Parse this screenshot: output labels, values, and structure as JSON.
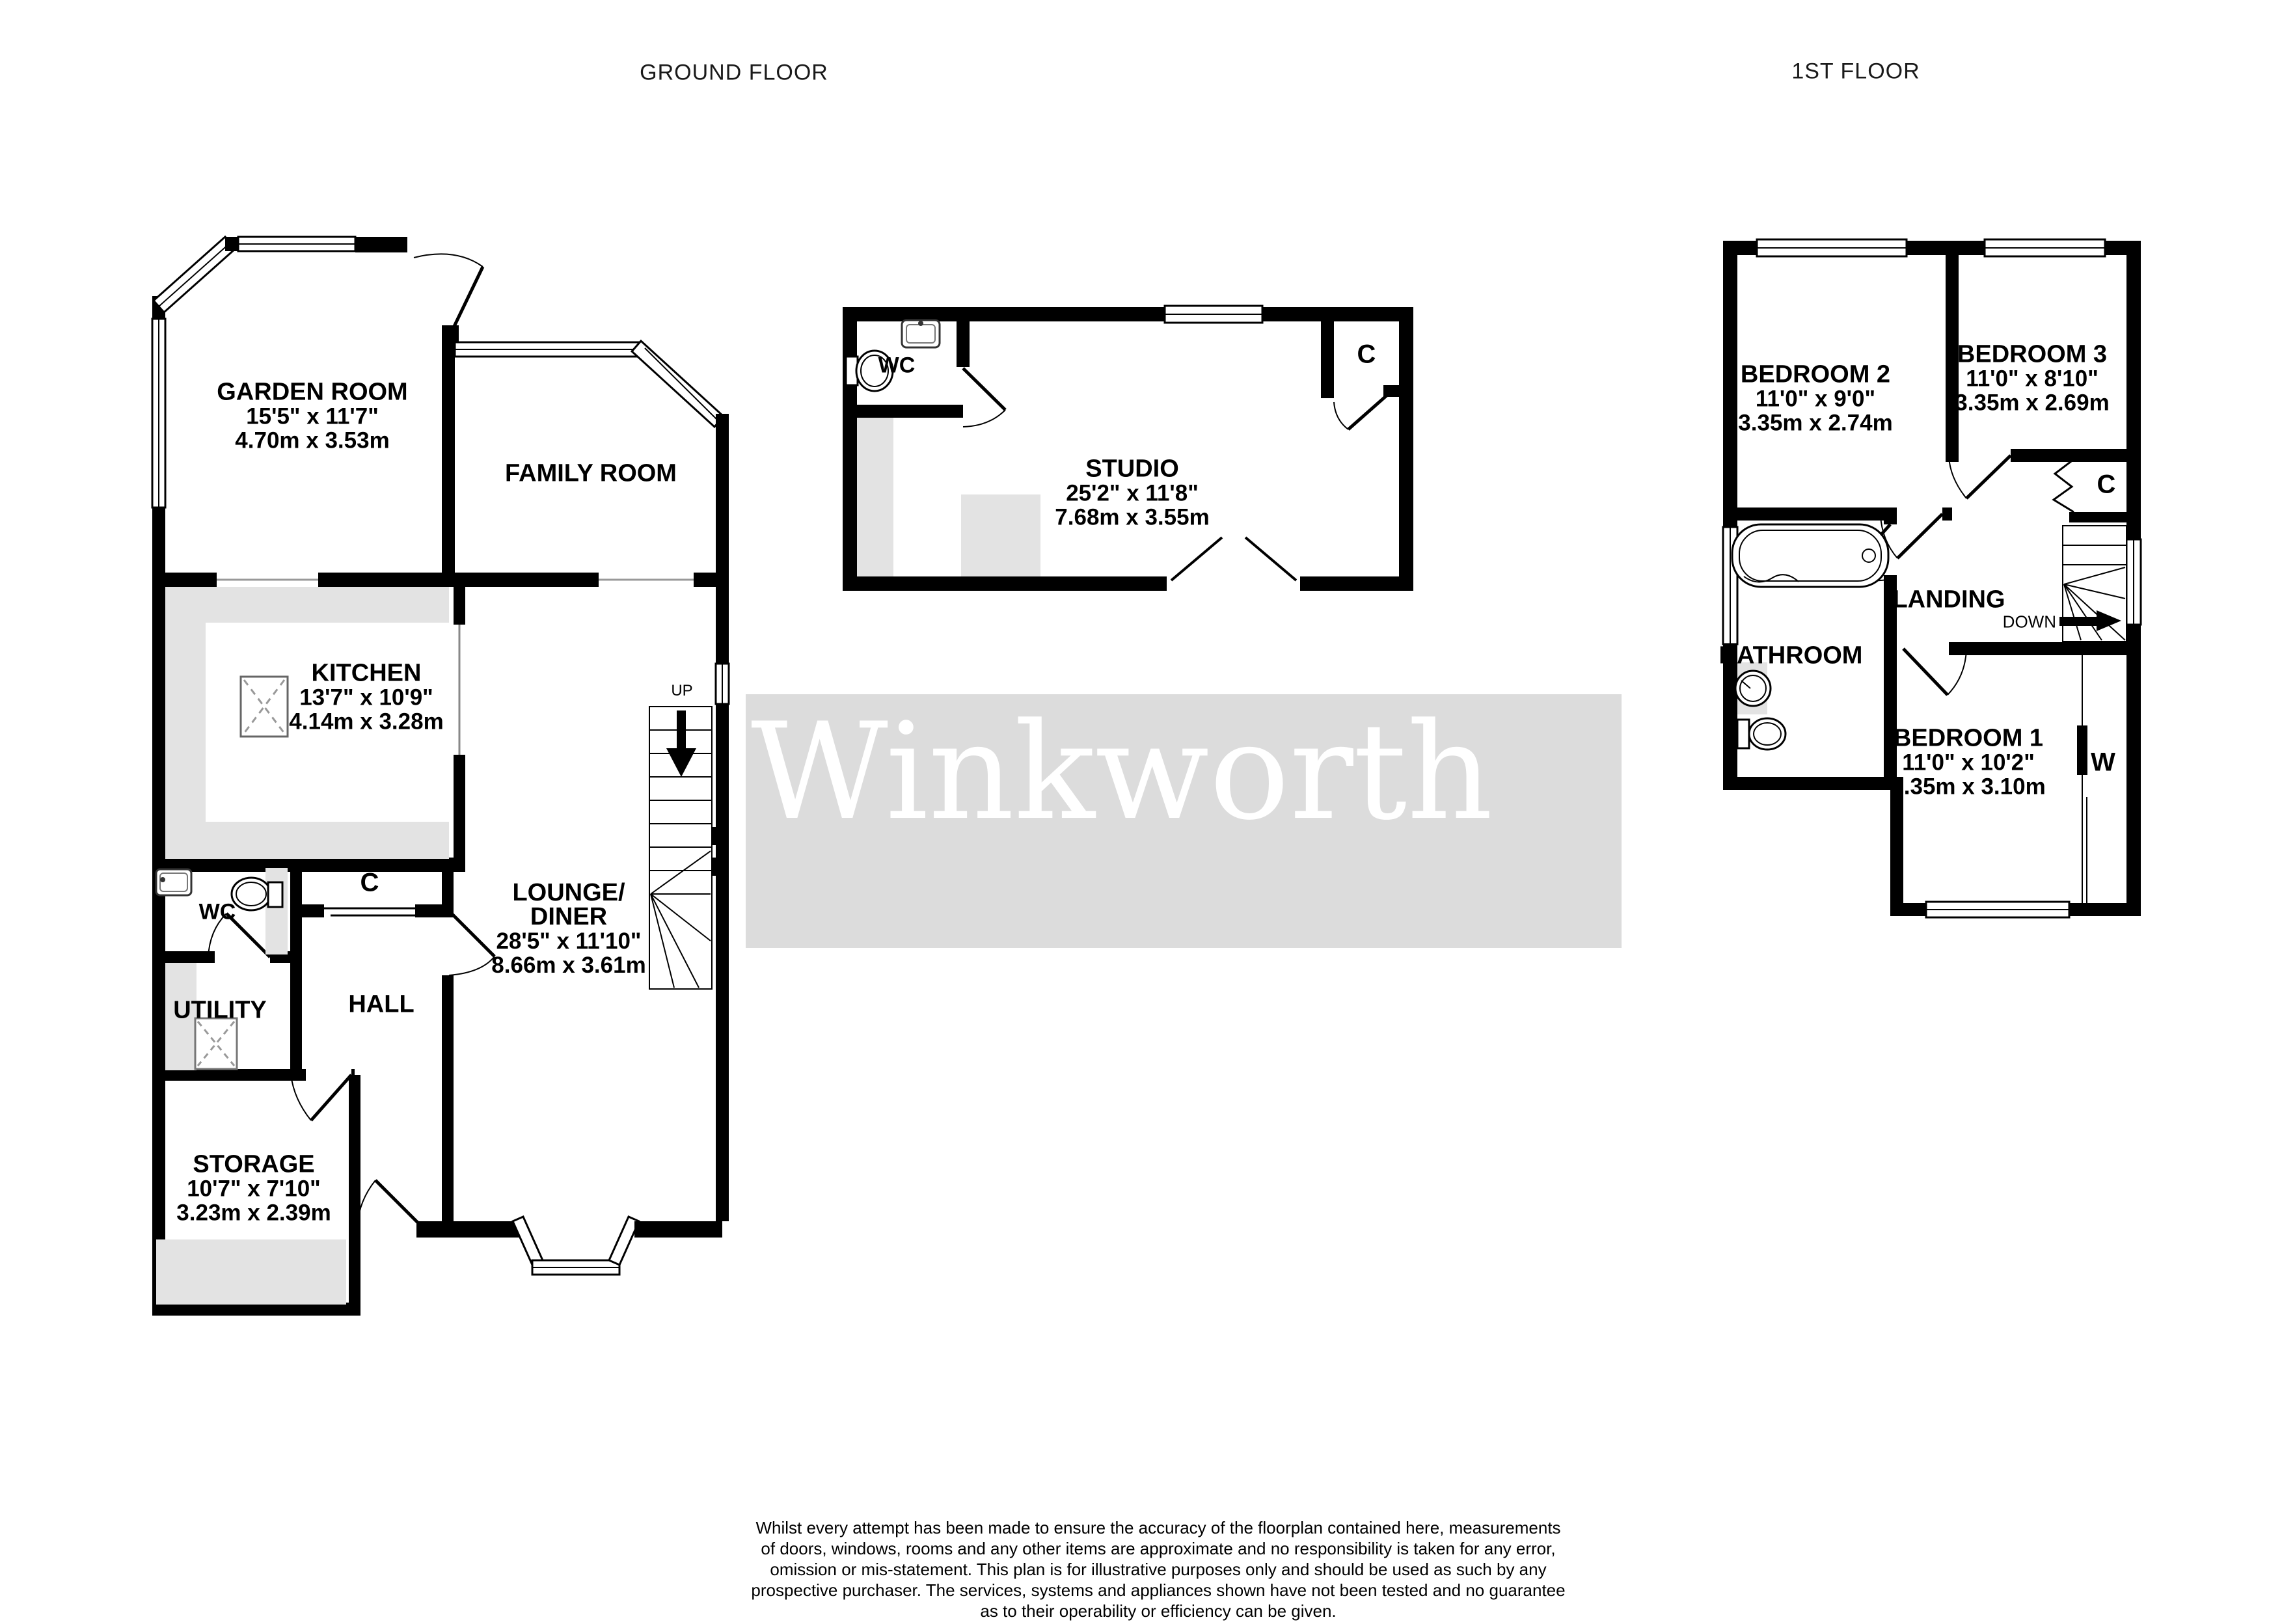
{
  "page": {
    "ground_floor_title": "GROUND FLOOR",
    "first_floor_title": "1ST FLOOR"
  },
  "colors": {
    "wall": "#000000",
    "fixture_gray": "#e3e3e3",
    "watermark_band": "#dcdcdc",
    "watermark_text": "#ffffff",
    "opening_line": "#999999"
  },
  "watermark": {
    "text": "Winkworth"
  },
  "rooms": {
    "garden_room": {
      "name": "GARDEN ROOM",
      "imperial": "15'5\"  x 11'7\"",
      "metric": "4.70m  x 3.53m"
    },
    "family_room": {
      "name": "FAMILY ROOM"
    },
    "kitchen": {
      "name": "KITCHEN",
      "imperial": "13'7\"  x 10'9\"",
      "metric": "4.14m  x 3.28m"
    },
    "lounge_diner": {
      "name_line1": "LOUNGE/",
      "name_line2": "DINER",
      "imperial": "28'5\"  x 11'10\"",
      "metric": "8.66m  x 3.61m"
    },
    "hall": {
      "name": "HALL"
    },
    "utility": {
      "name": "UTILITY"
    },
    "wc_ground": {
      "name": "WC"
    },
    "storage": {
      "name": "STORAGE",
      "imperial": "10'7\"  x 7'10\"",
      "metric": "3.23m  x 2.39m"
    },
    "studio": {
      "name": "STUDIO",
      "imperial": "25'2\"  x 11'8\"",
      "metric": "7.68m  x 3.55m"
    },
    "wc_studio": {
      "name": "WC"
    },
    "bedroom1": {
      "name": "BEDROOM 1",
      "imperial": "11'0\"  x 10'2\"",
      "metric": "3.35m  x 3.10m"
    },
    "bedroom2": {
      "name": "BEDROOM 2",
      "imperial": "11'0\"  x 9'0\"",
      "metric": "3.35m  x 2.74m"
    },
    "bedroom3": {
      "name": "BEDROOM 3",
      "imperial": "11'0\"  x 8'10\"",
      "metric": "3.35m  x 2.69m"
    },
    "bathroom": {
      "name": "BATHROOM"
    },
    "landing": {
      "name": "LANDING"
    }
  },
  "labels": {
    "up": "UP",
    "down": "DOWN",
    "cupboard": "C",
    "wardrobe": "W"
  },
  "footer": {
    "disclaimer_lines": [
      "Whilst every attempt has been made to ensure the accuracy of the floorplan contained here, measurements",
      "of doors, windows, rooms and any other items are approximate and no responsibility is taken for any error,",
      "omission or mis-statement. This plan is for illustrative purposes only and should be used as such by any",
      "prospective purchaser. The services, systems and appliances shown have not been tested and no guarantee",
      "as to their operability or efficiency can be given."
    ],
    "credit": "Made with Metropix ©2025"
  }
}
